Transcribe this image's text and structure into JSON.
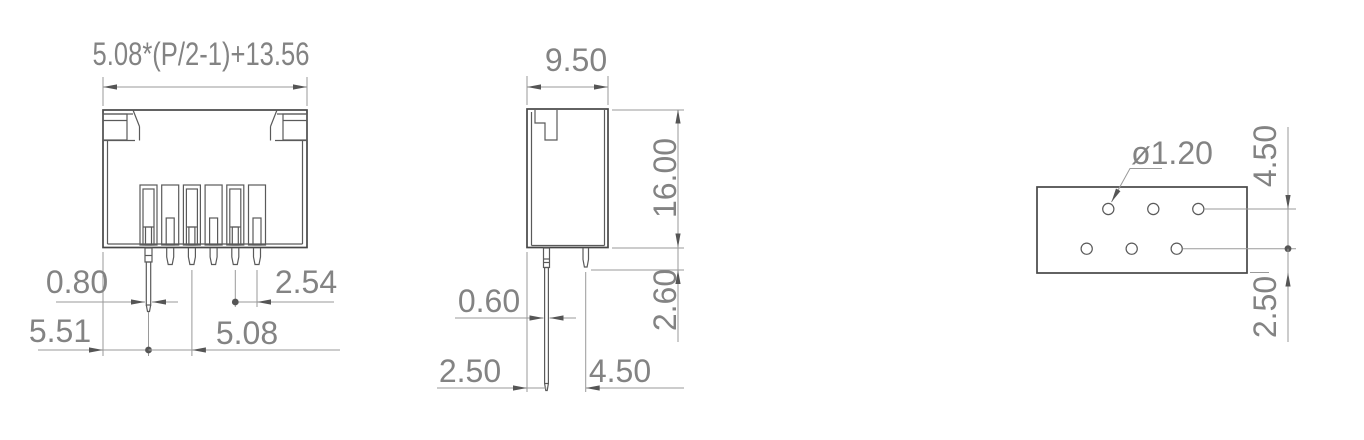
{
  "drawing": {
    "type": "connector-dimension-drawing",
    "views": {
      "front": {
        "pin_count": 6,
        "dims": {
          "width_formula": "5.08*(P/2-1)+13.56",
          "pin_width": "0.80",
          "edge_to_first_pin": "5.51",
          "pitch_long_pins": "5.08",
          "pitch_adjacent": "2.54"
        }
      },
      "side": {
        "dims": {
          "body_width": "9.50",
          "body_height": "16.00",
          "short_pin_tail": "2.60",
          "pin_thickness": "0.60",
          "front_row_offset": "2.50",
          "row_spacing": "4.50"
        }
      },
      "pcb_layout": {
        "hole_rows": 2,
        "holes_per_row": 3,
        "dims": {
          "hole_diameter": "ø1.20",
          "row_spacing": "4.50",
          "edge_offset": "2.50"
        }
      }
    },
    "colors": {
      "part_line": "#474747",
      "dimension_line": "#9a9a9a",
      "arrow": "#555555",
      "text": "#838383",
      "background": "#ffffff"
    }
  }
}
